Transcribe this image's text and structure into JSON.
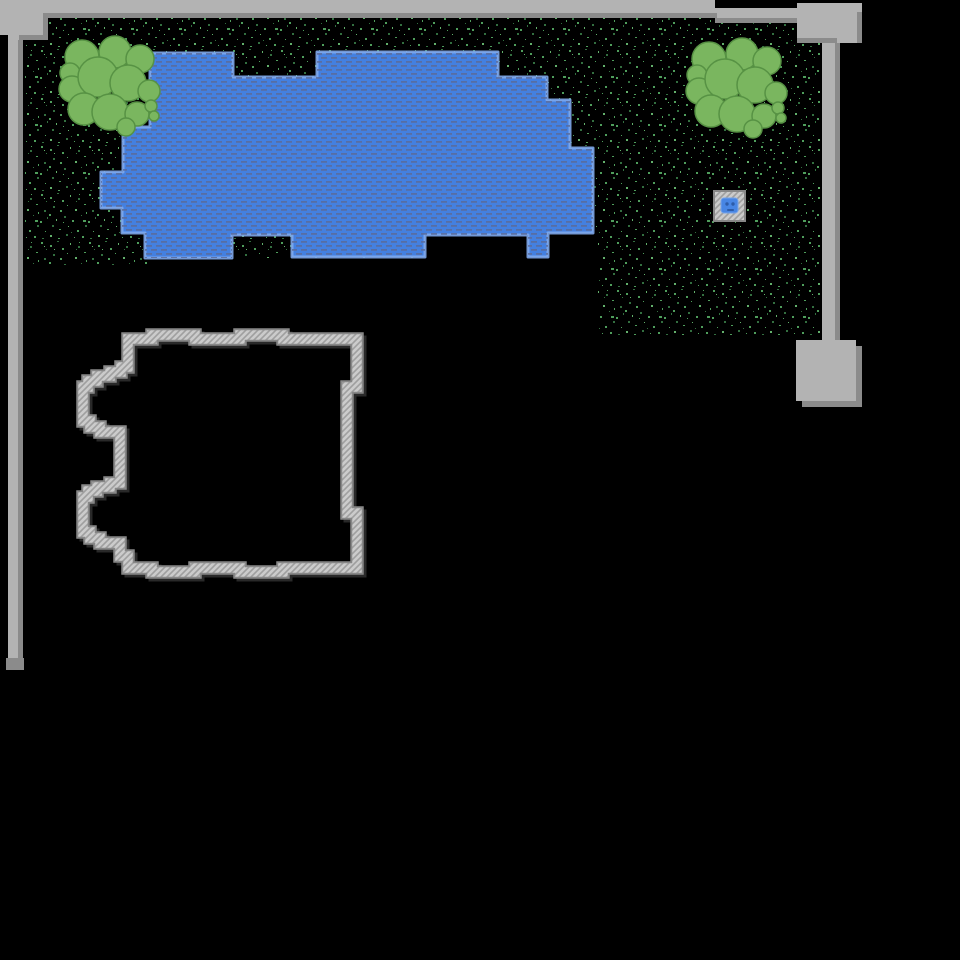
{
  "scene": {
    "width": 960,
    "height": 960,
    "background": "#000000",
    "colors": {
      "wall_light": "#b3b3b3",
      "wall_dark": "#8b8b8b",
      "water_fill": "#4480e0",
      "water_edge": "#7fa8ec",
      "water_dash": "#5a6b9a",
      "grass_dot_a": "#4f9d5c",
      "grass_dot_b": "#336f40",
      "grass_dot_c": "#63b06c",
      "tree_fill": "#7ab65f",
      "tree_stroke": "#579244",
      "hatch_bg": "#cbcbcb",
      "hatch_line": "#9f9f9f",
      "hatch_edge": "#878787",
      "hatch_shadow": "#4a4a4a",
      "marker_blue": "#4886e4",
      "marker_face": "#2d5ca8"
    },
    "grass_path": "M 25,40 H 48 V 18 H 797 V 43 H 820 V 337 H 597 V 233 H 548 V 257 H 528 V 235 H 425 V 258 H 155 V 265 H 25 Z",
    "water_path": "M 150,53 H 233 V 77 H 317 V 52 H 498 V 77 H 547 V 100 H 570 V 148 H 593 V 233 H 548 V 257 H 528 V 235 H 425 V 257 H 292 V 235 H 232 V 258 H 145 V 233 H 122 V 208 H 101 V 172 H 123 V 127 H 150 Z",
    "building_path": "M 128,339 H 152 V 335 H 195 V 339 H 240 V 335 H 283 V 339 H 357 V 387 H 347 V 513 H 357 V 568 H 283 V 572 H 240 V 568 H 195 V 572 H 152 V 568 H 128 V 556 H 120 V 543 H 100 V 538 H 90 V 532 H 83 V 497 H 88 V 491 H 97 V 487 H 110 V 483 H 120 V 432 H 100 V 427 H 90 V 421 H 83 V 387 H 88 V 381 H 97 V 376 H 110 V 372 H 121 V 367 H 128 Z",
    "building_shadow_offset": "translate(3,3)",
    "walls": [
      {
        "name": "perimeter-wall-top",
        "x": 0,
        "y": 0,
        "w": 715,
        "h": 13,
        "tone": "light",
        "i": true
      },
      {
        "name": "perimeter-wall-top-right",
        "x": 715,
        "y": 8,
        "w": 82,
        "h": 10,
        "tone": "light",
        "i": true
      },
      {
        "name": "perimeter-wall-top-inner-edge",
        "x": 43,
        "y": 13,
        "w": 674,
        "h": 5,
        "tone": "dark",
        "i": false
      },
      {
        "name": "perimeter-wall-top-right-inner-edge",
        "x": 715,
        "y": 18,
        "w": 82,
        "h": 5,
        "tone": "dark",
        "i": false
      },
      {
        "name": "corner-pillar-nw",
        "x": 0,
        "y": 0,
        "w": 43,
        "h": 35,
        "tone": "light",
        "i": true
      },
      {
        "name": "corner-pillar-nw-edge-right",
        "x": 43,
        "y": 13,
        "w": 5,
        "h": 27,
        "tone": "dark",
        "i": false
      },
      {
        "name": "corner-pillar-nw-edge-bottom",
        "x": 18,
        "y": 35,
        "w": 30,
        "h": 5,
        "tone": "dark",
        "i": false
      },
      {
        "name": "perimeter-wall-left",
        "x": 8,
        "y": 35,
        "w": 11,
        "h": 625,
        "tone": "light",
        "i": true
      },
      {
        "name": "perimeter-wall-left-inner-edge",
        "x": 18,
        "y": 40,
        "w": 5,
        "h": 625,
        "tone": "dark",
        "i": false
      },
      {
        "name": "perimeter-wall-left-end-cap",
        "x": 6,
        "y": 658,
        "w": 18,
        "h": 12,
        "tone": "dark",
        "i": false
      },
      {
        "name": "gate-block-ne",
        "x": 797,
        "y": 3,
        "w": 65,
        "h": 40,
        "tone": "light",
        "i": true
      },
      {
        "name": "gate-block-ne-shadow-right",
        "x": 857,
        "y": 12,
        "w": 5,
        "h": 31,
        "tone": "dark",
        "i": false
      },
      {
        "name": "gate-block-ne-shadow-bottom",
        "x": 797,
        "y": 38,
        "w": 40,
        "h": 5,
        "tone": "dark",
        "i": false
      },
      {
        "name": "perimeter-wall-right-strip",
        "x": 822,
        "y": 43,
        "w": 13,
        "h": 297,
        "tone": "light",
        "i": true
      },
      {
        "name": "perimeter-wall-right-strip-edge",
        "x": 835,
        "y": 43,
        "w": 5,
        "h": 297,
        "tone": "dark",
        "i": false
      },
      {
        "name": "gate-block-se",
        "x": 796,
        "y": 340,
        "w": 60,
        "h": 61,
        "tone": "light",
        "i": true
      },
      {
        "name": "gate-block-se-shadow-right",
        "x": 856,
        "y": 346,
        "w": 6,
        "h": 61,
        "tone": "dark",
        "i": false
      },
      {
        "name": "gate-block-se-shadow-bottom",
        "x": 802,
        "y": 401,
        "w": 60,
        "h": 6,
        "tone": "dark",
        "i": false
      }
    ],
    "trees": [
      {
        "transform": "translate(110,85)"
      },
      {
        "transform": "translate(737,87)"
      }
    ],
    "tree_blobs": [
      [
        -28,
        -28,
        17
      ],
      [
        5,
        -33,
        16
      ],
      [
        30,
        -26,
        14
      ],
      [
        -40,
        -12,
        10
      ],
      [
        -38,
        4,
        13
      ],
      [
        -12,
        -8,
        20
      ],
      [
        18,
        -2,
        18
      ],
      [
        39,
        6,
        11
      ],
      [
        -26,
        24,
        16
      ],
      [
        0,
        27,
        18
      ],
      [
        27,
        29,
        12
      ],
      [
        41,
        21,
        6
      ],
      [
        44,
        31,
        5
      ],
      [
        16,
        42,
        9
      ]
    ],
    "marker": {
      "frame": {
        "x": 714,
        "y": 191,
        "w": 31,
        "h": 30
      },
      "pool": {
        "x": 721,
        "y": 198,
        "w": 17,
        "h": 15
      },
      "eyes": [
        [
          727,
          204
        ],
        [
          733,
          204
        ]
      ],
      "eye_r": 1.7,
      "mouth": {
        "x": 727,
        "y": 209,
        "w": 7,
        "h": 2
      }
    },
    "textures": {
      "speckle_tile": 48,
      "speckles": [
        [
          2,
          5,
          2,
          2,
          "a"
        ],
        [
          9,
          1,
          2,
          1,
          "b"
        ],
        [
          14,
          8,
          2,
          2,
          "a"
        ],
        [
          22,
          3,
          1,
          2,
          "c"
        ],
        [
          30,
          6,
          2,
          2,
          "b"
        ],
        [
          41,
          2,
          2,
          2,
          "a"
        ],
        [
          46,
          9,
          1,
          1,
          "b"
        ],
        [
          5,
          14,
          2,
          2,
          "b"
        ],
        [
          12,
          18,
          2,
          2,
          "a"
        ],
        [
          19,
          13,
          1,
          1,
          "a"
        ],
        [
          27,
          17,
          2,
          2,
          "c"
        ],
        [
          36,
          12,
          2,
          1,
          "a"
        ],
        [
          44,
          18,
          2,
          2,
          "b"
        ],
        [
          1,
          22,
          2,
          2,
          "a"
        ],
        [
          8,
          27,
          1,
          2,
          "c"
        ],
        [
          16,
          24,
          2,
          2,
          "b"
        ],
        [
          24,
          28,
          2,
          2,
          "a"
        ],
        [
          33,
          23,
          1,
          1,
          "b"
        ],
        [
          40,
          29,
          2,
          2,
          "a"
        ],
        [
          47,
          25,
          1,
          2,
          "b"
        ],
        [
          4,
          33,
          2,
          2,
          "b"
        ],
        [
          11,
          37,
          2,
          1,
          "a"
        ],
        [
          20,
          34,
          1,
          1,
          "c"
        ],
        [
          29,
          38,
          2,
          2,
          "a"
        ],
        [
          37,
          33,
          2,
          2,
          "b"
        ],
        [
          45,
          39,
          1,
          1,
          "a"
        ],
        [
          2,
          43,
          2,
          2,
          "c"
        ],
        [
          10,
          46,
          2,
          1,
          "a"
        ],
        [
          18,
          42,
          2,
          2,
          "b"
        ],
        [
          26,
          45,
          1,
          1,
          "a"
        ],
        [
          34,
          44,
          2,
          2,
          "a"
        ],
        [
          42,
          46,
          2,
          1,
          "b"
        ],
        [
          6,
          9,
          1,
          1,
          "c"
        ],
        [
          38,
          20,
          1,
          2,
          "a"
        ],
        [
          23,
          40,
          1,
          1,
          "b"
        ],
        [
          15,
          30,
          1,
          1,
          "a"
        ],
        [
          31,
          2,
          1,
          1,
          "a"
        ],
        [
          44,
          6,
          1,
          1,
          "c"
        ],
        [
          28,
          9,
          1,
          1,
          "b"
        ],
        [
          35,
          28,
          3,
          2,
          "a"
        ]
      ],
      "dash_tile": {
        "w": 10,
        "h": 8
      },
      "water_dashes": [
        [
          1,
          1,
          6,
          1.8
        ],
        [
          6,
          5,
          4,
          1.8
        ],
        [
          0,
          5,
          2,
          1.8
        ]
      ]
    }
  }
}
